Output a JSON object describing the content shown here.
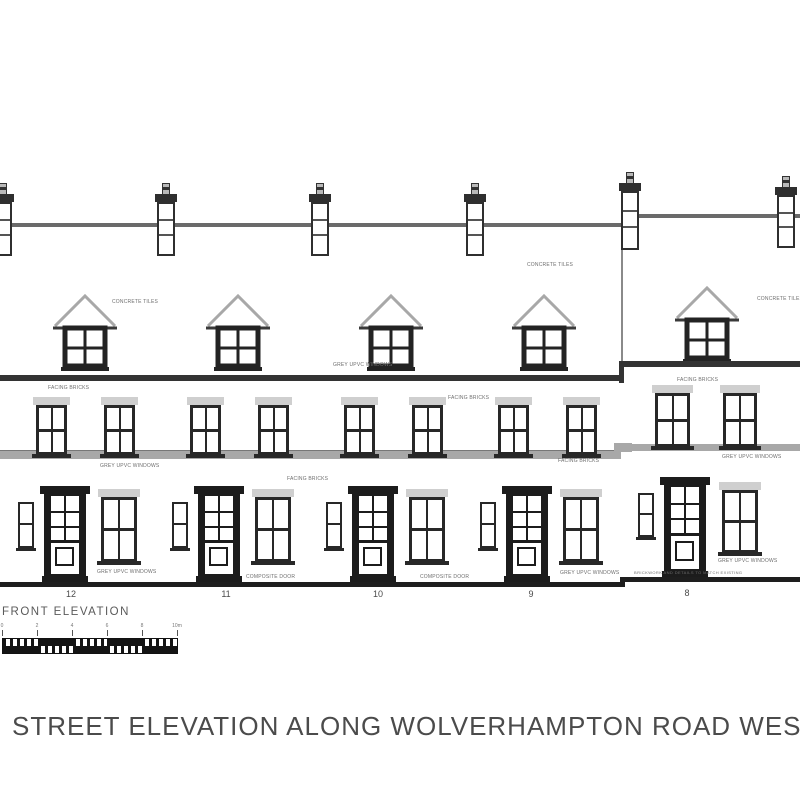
{
  "page_title": "STREET ELEVATION ALONG WOLVERHAMPTON ROAD WEST",
  "drawing": {
    "elevation_label": "FRONT ELEVATION",
    "houses": [
      {
        "number": "12"
      },
      {
        "number": "11"
      },
      {
        "number": "10"
      },
      {
        "number": "9"
      },
      {
        "number": "8"
      }
    ],
    "annotations": [
      {
        "text": "CONCRETE TILES"
      },
      {
        "text": "CONCRETE TILES"
      },
      {
        "text": "CONCRETE TILES"
      },
      {
        "text": "GREY UPVC WINDOWS"
      },
      {
        "text": "FACING BRICKS"
      },
      {
        "text": "FACING BRICKS"
      },
      {
        "text": "FACING BRICKS"
      },
      {
        "text": "GREY UPVC WINDOWS"
      },
      {
        "text": "FACING BRICKS"
      },
      {
        "text": "FACING BRICKS"
      },
      {
        "text": "GREY UPVC WINDOWS"
      },
      {
        "text": "GREY UPVC WINDOWS"
      },
      {
        "text": "COMPOSITE DOOR"
      },
      {
        "text": "COMPOSITE DOOR"
      },
      {
        "text": "GREY UPVC WINDOWS"
      },
      {
        "text": "GREY UPVC WINDOWS"
      },
      {
        "text": "BRICKWORK AND DETAILS TO MATCH EXISTING"
      }
    ],
    "scale_bar": {
      "tick_labels": [
        "0",
        "2",
        "4",
        "6",
        "8",
        "10m"
      ]
    },
    "colors": {
      "line_dark": "#1e1e1e",
      "line_mid": "#6a6a6a",
      "band_grey": "#a8a8a8",
      "lintel_grey": "#cfcfcf",
      "title_grey": "#4b4b4b"
    }
  }
}
